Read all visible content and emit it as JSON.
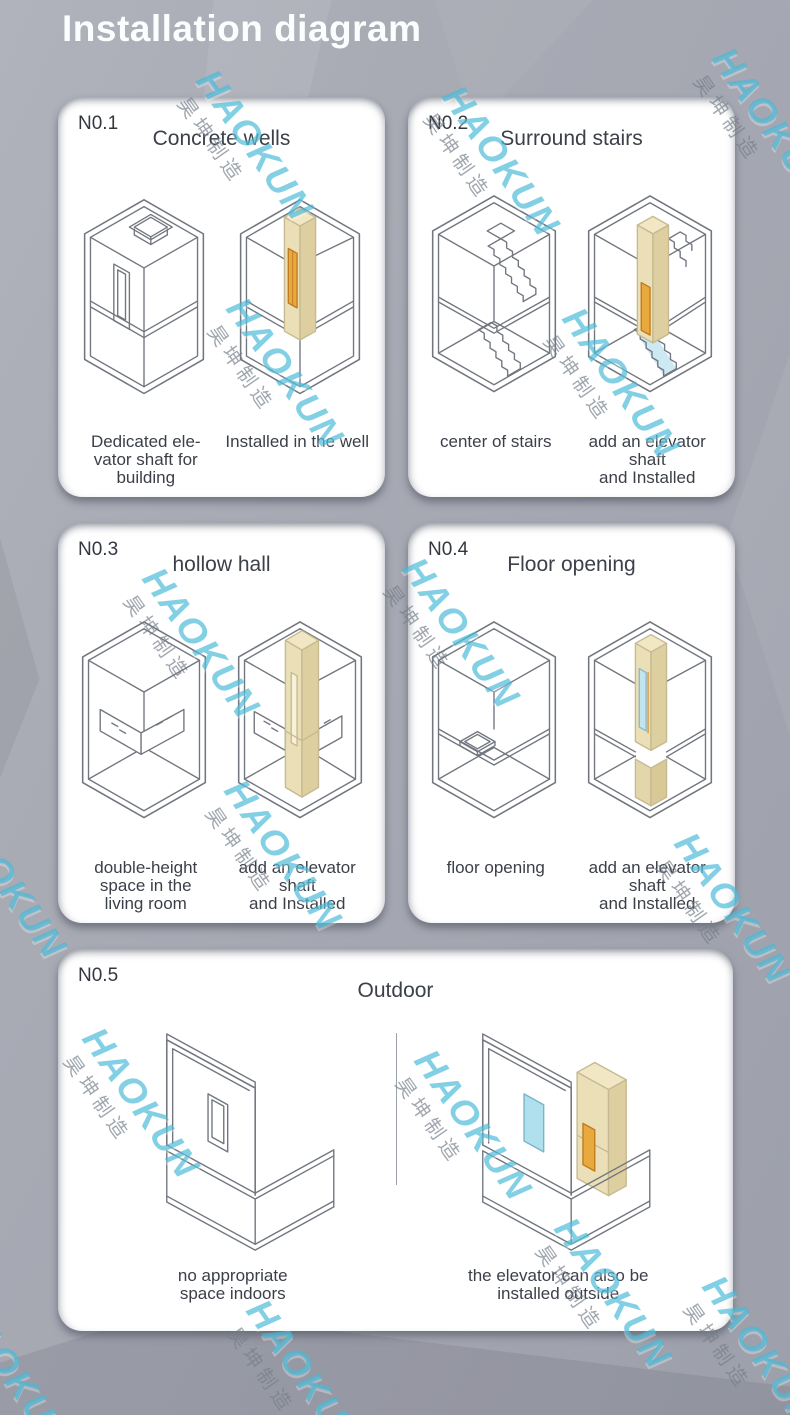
{
  "page": {
    "title": "Installation diagram"
  },
  "watermark": {
    "brand": "HAOKUN",
    "brand_cn": "昊坤制造",
    "color": "#48bad8"
  },
  "colors": {
    "elevator_beige": "#eadfb6",
    "elevator_door_orange": "#e9a93f",
    "glass_cyan": "#bfe3ef",
    "line_gray": "#71767f"
  },
  "cards": [
    {
      "number": "N0.1",
      "title": "Concrete wells",
      "captions": [
        "Dedicated ele-\nvator shaft for\nbuilding",
        "Installed in the well"
      ]
    },
    {
      "number": "N0.2",
      "title": "Surround stairs",
      "captions": [
        "center of stairs",
        "add an elevator shaft\nand Installed"
      ]
    },
    {
      "number": "N0.3",
      "title": "hollow hall",
      "captions": [
        "double-height\nspace in the\nliving room",
        "add an elevator shaft\nand Installed"
      ]
    },
    {
      "number": "N0.4",
      "title": "Floor opening",
      "captions": [
        "floor opening",
        "add an elevator shaft\nand Installed"
      ]
    },
    {
      "number": "N0.5",
      "title": "Outdoor",
      "captions": [
        "no appropriate\nspace indoors",
        "the elevator can also be\ninstalled outside"
      ]
    }
  ]
}
